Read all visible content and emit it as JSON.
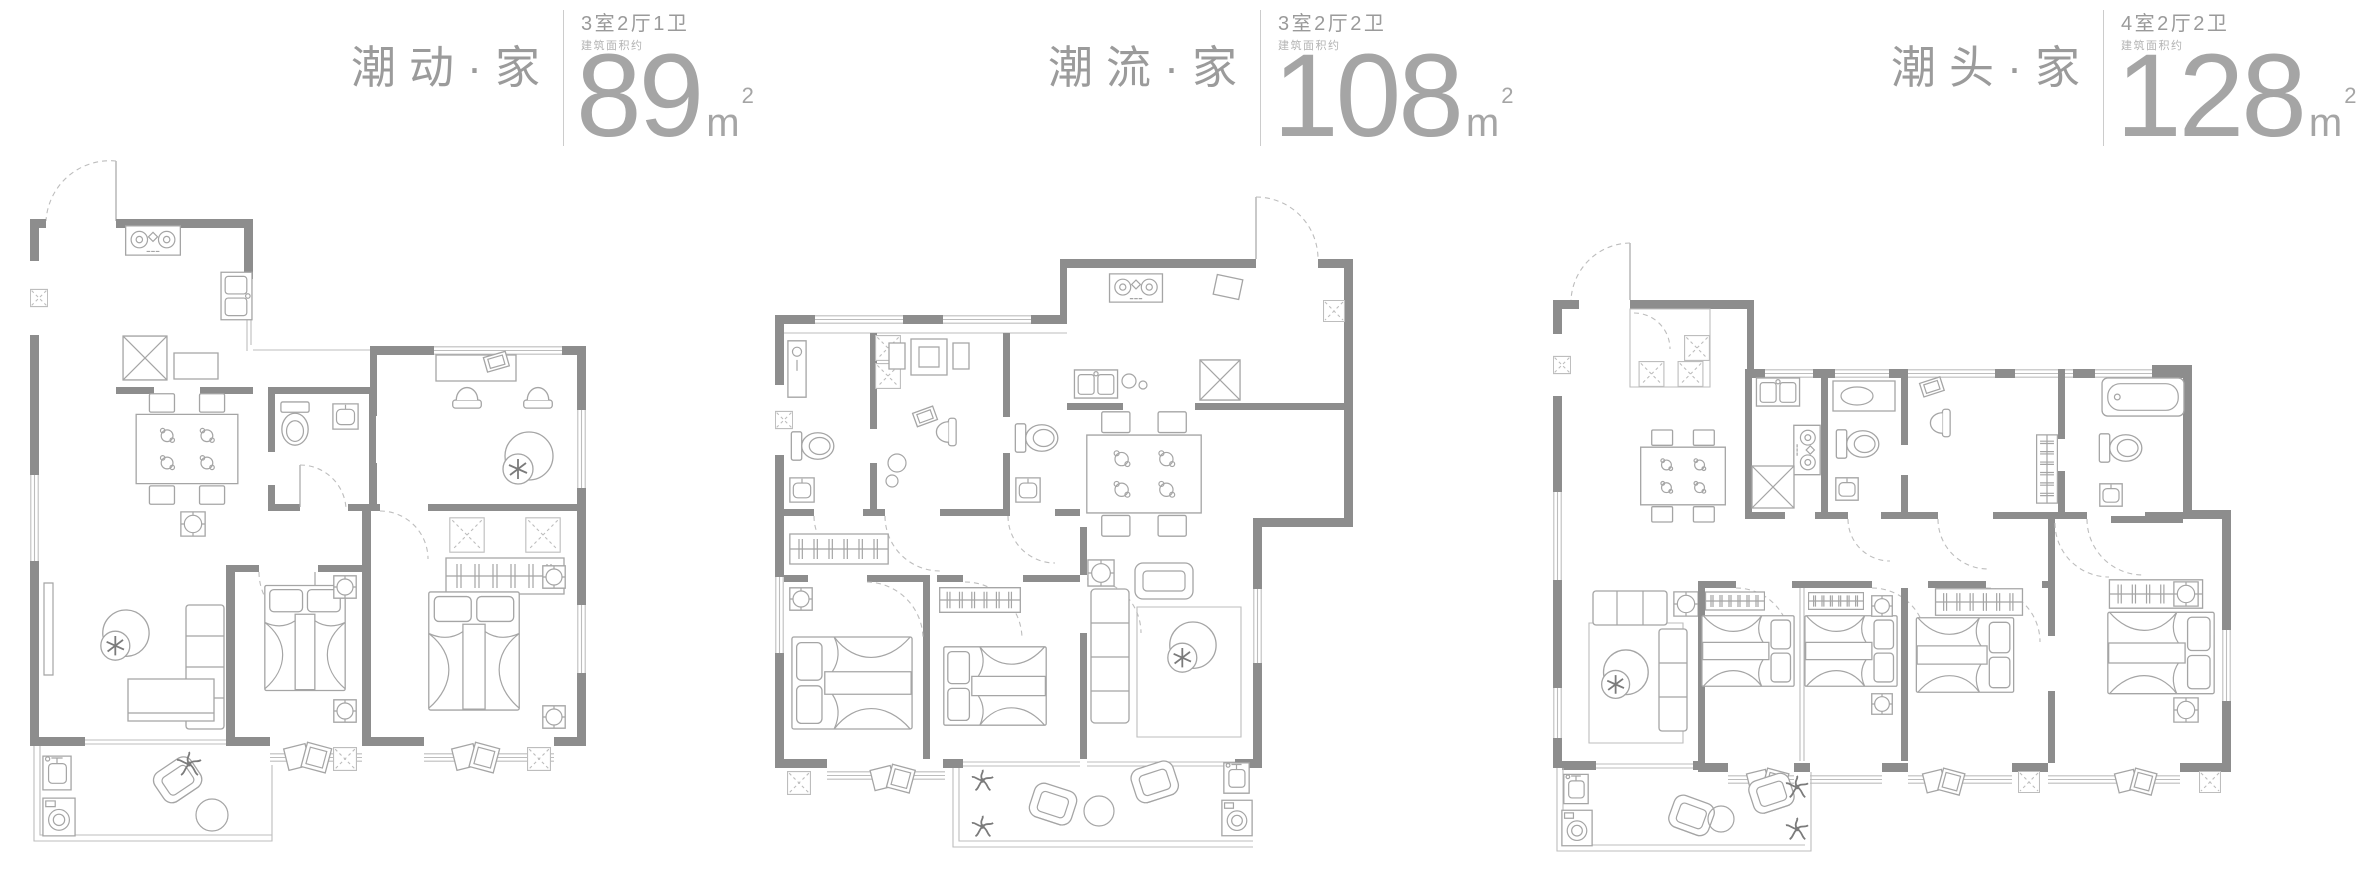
{
  "page": {
    "background": "#ffffff"
  },
  "colors": {
    "title_text": "#9b9b9b",
    "spec_text": "#9a9a9a",
    "note_text": "#b3b3b3",
    "area_text": "#a5a5a5",
    "divider": "#cccccc",
    "wall": "#8d8d8d",
    "furniture_line": "#a5a5a5",
    "thin_line": "#bdbdbd",
    "dark_accent": "#7b7b7b"
  },
  "plans": [
    {
      "title": "潮动·家",
      "layout_spec": "3室2厅1卫",
      "area_note": "建筑面积约",
      "area_value": "89",
      "area_unit": "m",
      "area_sup": "2"
    },
    {
      "title": "潮流·家",
      "layout_spec": "3室2厅2卫",
      "area_note": "建筑面积约",
      "area_value": "108",
      "area_unit": "m",
      "area_sup": "2"
    },
    {
      "title": "潮头·家",
      "layout_spec": "4室2厅2卫",
      "area_note": "建筑面积约",
      "area_value": "128",
      "area_unit": "m",
      "area_sup": "2"
    }
  ]
}
